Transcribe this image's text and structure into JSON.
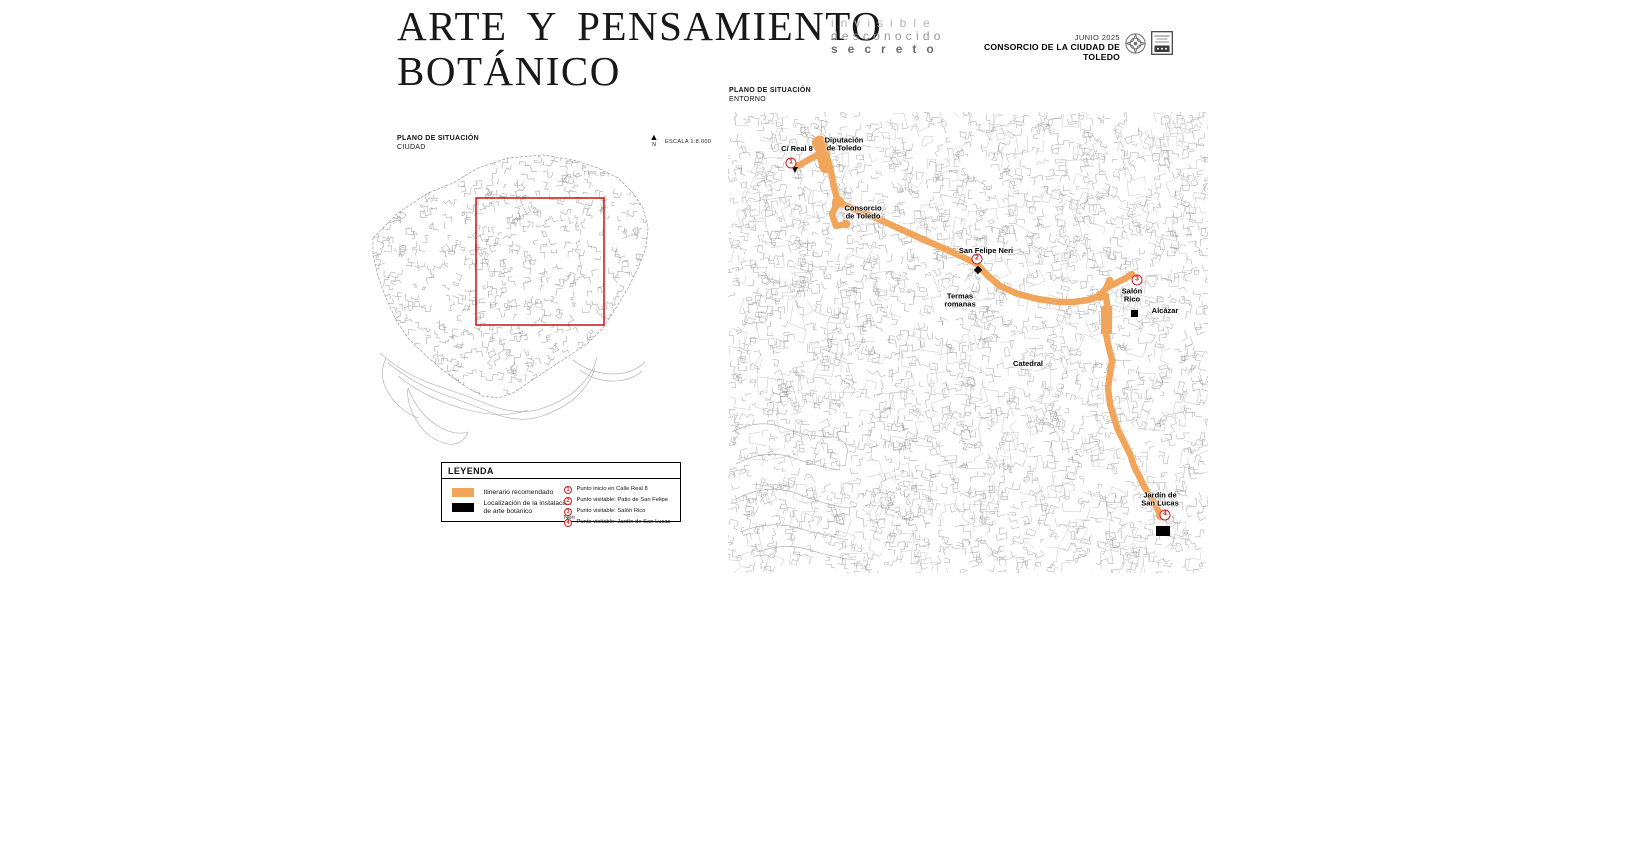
{
  "document": {
    "title_line1": "ARTE Y PENSAMIENTO",
    "title_line2": "BOTÁNICO"
  },
  "header": {
    "brand_line1": "invisible",
    "brand_line2": "desconocido",
    "brand_line3": "secreto",
    "date": "JUNIO 2025",
    "organization": "CONSORCIO DE LA CIUDAD DE TOLEDO",
    "logo_icons": [
      "rosette-seal-icon",
      "consorcio-shield-icon"
    ]
  },
  "city_plan": {
    "title": "PLANO DE SITUACIÓN",
    "subtitle": "CIUDAD",
    "north_label": "N",
    "scale_label": "ESCALA 1:8.000"
  },
  "legend": {
    "title": "LEYENDA",
    "swatches": [
      {
        "color": "#F0A55B",
        "label": "Itinerario recomendado"
      },
      {
        "color": "#000000",
        "label": "Localización de la instalación\nde arte botánico"
      }
    ],
    "points": [
      {
        "num": "1",
        "label": "Punto inicio en Calle Real 8"
      },
      {
        "num": "2",
        "label": "Punto visitable: Patio de San Felipe Neri"
      },
      {
        "num": "3",
        "label": "Punto visitable: Salón Rico"
      },
      {
        "num": "4",
        "label": "Punto visitable: Jardín de San Lucas"
      }
    ]
  },
  "area_plan": {
    "title": "PLANO DE SITUACIÓN",
    "subtitle": "ENTORNO",
    "labels": [
      "C/ Real 8",
      "Diputación\nde Toledo",
      "Consorcio\nde Toledo",
      "San Felipe Neri",
      "Termas\nromanas",
      "Salón\nRico",
      "Alcázar",
      "Catedral",
      "Jardín de\nSan Lucas"
    ],
    "markers": [
      "1",
      "2",
      "3",
      "4"
    ]
  },
  "colors": {
    "route_orange": "#F0A55B",
    "marker_red": "#CC2222",
    "map_ink": "#9A9A9A",
    "situation_rect_red": "#CC1111"
  }
}
